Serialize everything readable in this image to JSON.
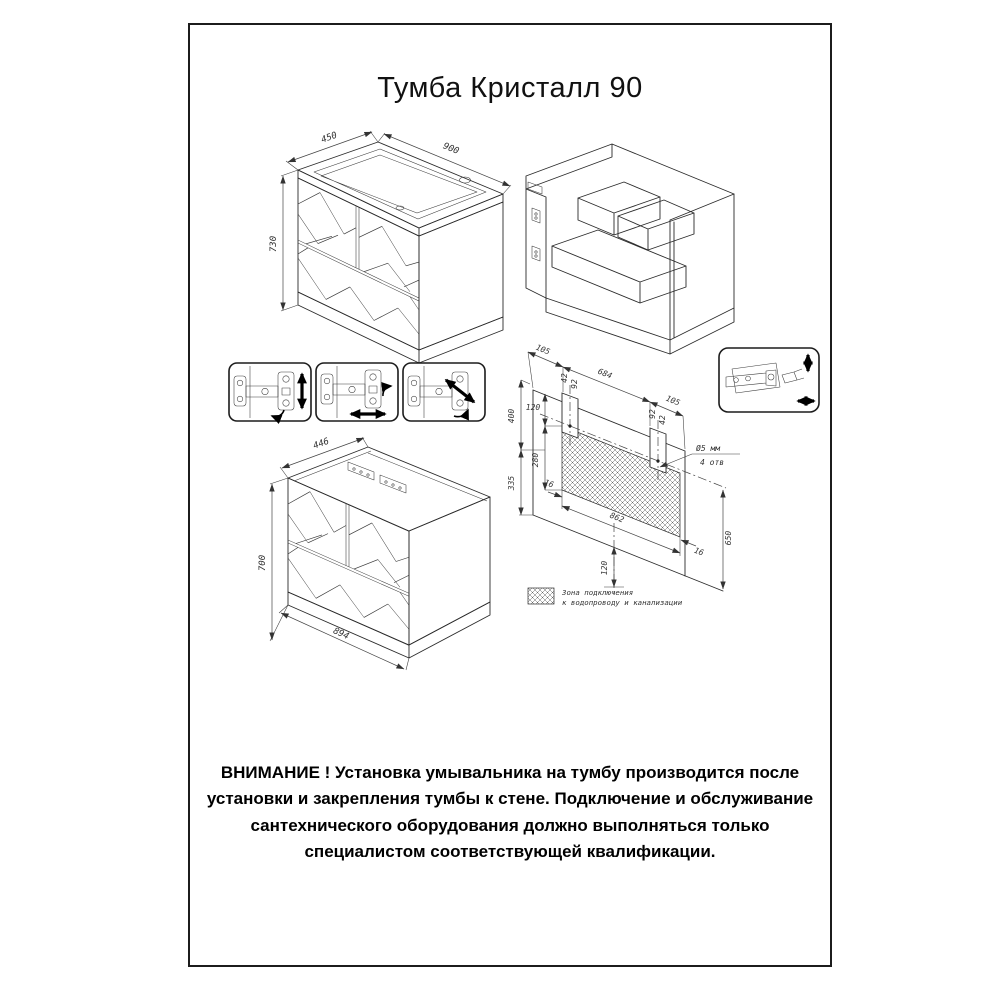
{
  "page": {
    "title": "Тумба Кристалл 90",
    "warning": "ВНИМАНИЕ ! Установка умывальника на тумбу производится после установки и закрепления тумбы к стене. Подключение и обслуживание сантехнического оборудования должно выполняться только специалистом соответствующей квалификации."
  },
  "front_view": {
    "dim_depth": "450",
    "dim_width": "900",
    "dim_height": "730"
  },
  "rear_view": {
    "dim_depth": "446",
    "dim_height": "700",
    "dim_width": "894"
  },
  "mounting_plan": {
    "dim_offset_left": "105",
    "dim_span": "684",
    "dim_offset_right": "105",
    "dim_col1_a": "42",
    "dim_col1_b": "92",
    "dim_col2_a": "92",
    "dim_col2_b": "42",
    "dim_zone_top": "120",
    "dim_upper_height": "400",
    "dim_zone_height": "280",
    "dim_lower_height": "335",
    "dim_zone_inset_left": "16",
    "dim_zone_width": "862",
    "dim_zone_inset_right": "16",
    "dim_total_height": "650",
    "dim_drain_offset": "120",
    "hole_note_line1": "Ø5 мм",
    "hole_note_line2": "4 отв",
    "legend_line1": "Зона подключения",
    "legend_line2": "к водопроводу и канализации"
  }
}
